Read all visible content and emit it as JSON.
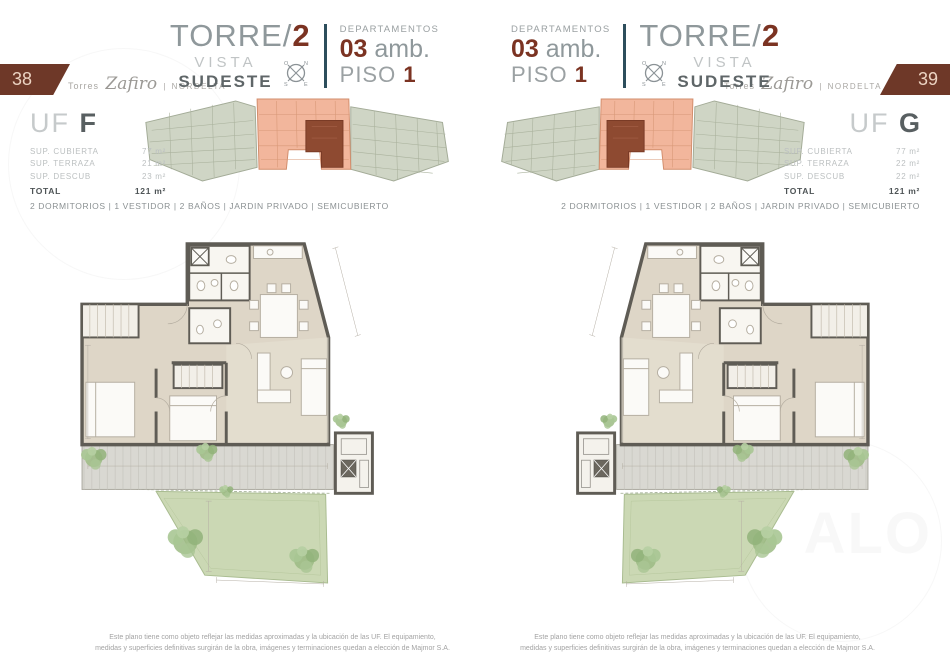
{
  "brand": {
    "prefix": "Torres",
    "script": "Zafiro",
    "sep": "|",
    "suffix": "NORDELTA"
  },
  "header": {
    "torre_prefix": "TORRE/",
    "torre_number": "2",
    "vista": "VISTA",
    "direction": "SUDESTE",
    "departamentos": "DEPARTAMENTOS",
    "amb_value": "03",
    "amb_label": " amb.",
    "piso_label": "PISO ",
    "piso_number": "1",
    "compass": {
      "o": "O",
      "n": "N",
      "s": "S",
      "e": "E"
    }
  },
  "features": "2 DORMITORIOS | 1 VESTIDOR | 2 BAÑOS | JARDIN PRIVADO | SEMICUBIERTO",
  "footer": {
    "line1": "Este plano tiene como objeto reflejar las medidas aproximadas y la ubicación de las UF. El equipamiento,",
    "line2": "medidas y superficies definitivas surgirán de la obra, imágenes y terminaciones quedan a elección de Majmor S.A."
  },
  "watermark": {
    "text": "ALO"
  },
  "pages": {
    "left": {
      "page_number": "38",
      "unit_prefix": "UF ",
      "unit_letter": "F",
      "areas": [
        {
          "label": "SUP. CUBIERTA",
          "value": "77 m²"
        },
        {
          "label": "SUP. TERRAZA",
          "value": "21 m²"
        },
        {
          "label": "SUP. DESCUB",
          "value": "23 m²"
        }
      ],
      "total_label": "TOTAL",
      "total_value": "121 m²"
    },
    "right": {
      "page_number": "39",
      "unit_prefix": "UF ",
      "unit_letter": "G",
      "areas": [
        {
          "label": "SUP. CUBIERTA",
          "value": "77 m²"
        },
        {
          "label": "SUP. TERRAZA",
          "value": "22 m²"
        },
        {
          "label": "SUP. DESCUB",
          "value": "22 m²"
        }
      ],
      "total_label": "TOTAL",
      "total_value": "121 m²"
    }
  }
}
